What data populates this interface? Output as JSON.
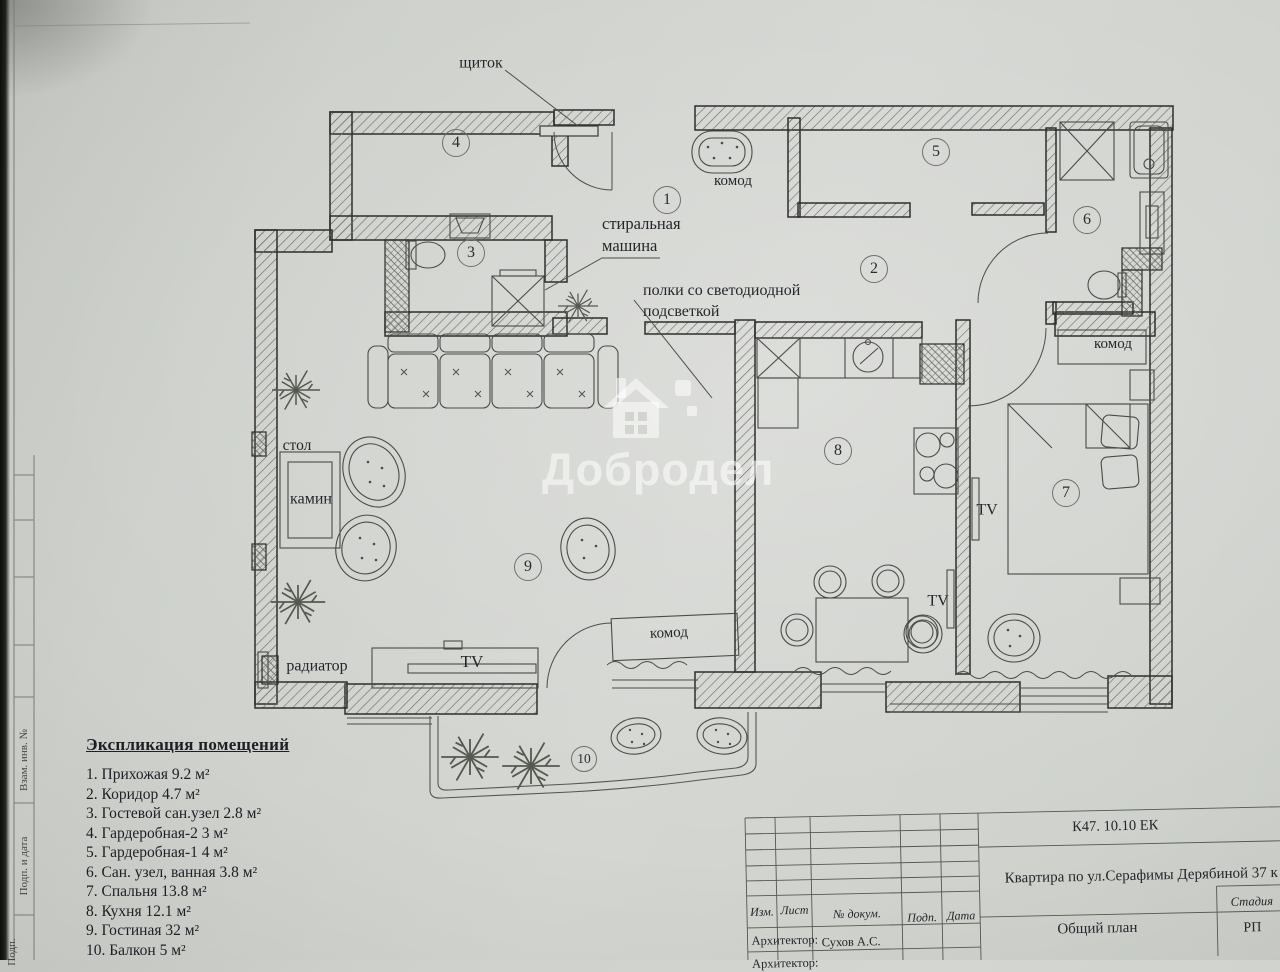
{
  "plan": {
    "labels": {
      "shchitok": "щиток",
      "komod_hall": "комод",
      "washer": "стиральная\nмашина",
      "shelves": "полки со светодиодной\nподсветкой",
      "stol": "стол",
      "kamin": "камин",
      "radiator": "радиатор",
      "tv_living": "TV",
      "tv_kitchen": "TV",
      "tv_bedroom": "TV",
      "komod_bedroom": "комод",
      "komod_living": "комод"
    },
    "rooms": [
      {
        "n": "1"
      },
      {
        "n": "2"
      },
      {
        "n": "3"
      },
      {
        "n": "4"
      },
      {
        "n": "5"
      },
      {
        "n": "6"
      },
      {
        "n": "7"
      },
      {
        "n": "8"
      },
      {
        "n": "9"
      },
      {
        "n": "10"
      }
    ]
  },
  "watermark": {
    "text": "Добродел"
  },
  "legend": {
    "title": "Экспликация помещений",
    "items": [
      "1. Прихожая  9.2 м²",
      "2. Коридор  4.7 м²",
      "3. Гостевой сан.узел  2.8 м²",
      "4. Гардеробная-2  3 м²",
      "5. Гардеробная-1  4 м²",
      "6. Сан. узел, ванная  3.8 м²",
      "7. Спальня  13.8 м²",
      "8. Кухня  12.1 м²",
      "9. Гостиная  32 м²",
      "10. Балкон  5 м²"
    ]
  },
  "titleblock": {
    "code": "К47. 10.10 ЕК",
    "project": "Квартира по ул.Серафимы Дерябиной 37 к",
    "col_izm": "Изм.",
    "col_list": "Лист",
    "col_dokum": "№ докум.",
    "col_podp": "Подп.",
    "col_data": "Дата",
    "architect_label": "Архитектор:",
    "architect_name": "Сухов А.С.",
    "architect_label2": "Архитектор:",
    "doc_title": "Общий план",
    "stage_label": "Стадия",
    "stage_value": "РП"
  },
  "frame": {
    "v1": "Взам. инв. №",
    "v2": "Подп. и дата",
    "v3": "Подп."
  }
}
